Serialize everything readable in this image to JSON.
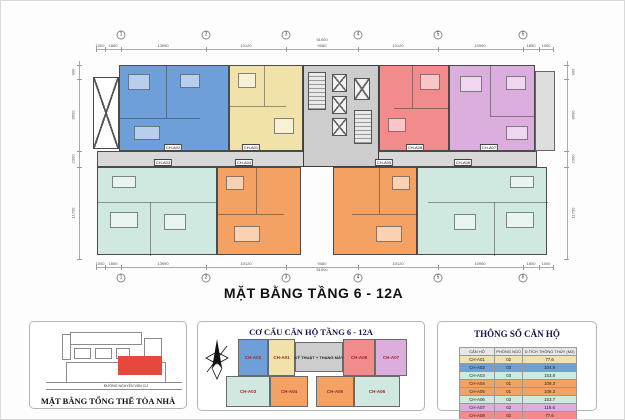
{
  "title": "MẶT BẰNG TẦNG 6 - 12A",
  "grid": {
    "bubbles": [
      "1",
      "2",
      "3",
      "4",
      "5",
      "6"
    ],
    "h_dims": [
      "1000",
      "1850",
      "13990",
      "10120",
      "9080",
      "10120",
      "10990",
      "1850",
      "1000"
    ],
    "h_total": "51000",
    "v_dims": [
      "900",
      "8600",
      "2300",
      "11700"
    ]
  },
  "apartments": [
    {
      "id": "CH-A01",
      "color": "#f1e2a9"
    },
    {
      "id": "CH-A02",
      "color": "#6f9fd8"
    },
    {
      "id": "CH-A03",
      "color": "#cfe9e1"
    },
    {
      "id": "CH-A04",
      "color": "#f4a263"
    },
    {
      "id": "CH-A05",
      "color": "#f4a263"
    },
    {
      "id": "CH-A06",
      "color": "#cfe9e1"
    },
    {
      "id": "CH-A07",
      "color": "#dcaede"
    },
    {
      "id": "CH-A08",
      "color": "#f28b8b"
    }
  ],
  "core": {
    "color": "#cdcdcd",
    "corridor_color": "#d8d8d8"
  },
  "site_panel": {
    "caption": "MẶT BẰNG TỔNG THỂ TÒA NHÀ",
    "street": "ĐƯỜNG NGUYỄN VĂN CỪ",
    "highlight_color": "#e8483b"
  },
  "legend_panel": {
    "title": "CƠ CẤU CĂN HỘ TẦNG 6 - 12A",
    "core_label": "KỸ THUẬT + THANG MÁY"
  },
  "specs_panel": {
    "title": "THÔNG SỐ CĂN HỘ",
    "columns": [
      "CĂN HỘ",
      "PHÒNG NGỦ",
      "D.TÍCH THÔNG THỦY (M2)"
    ],
    "rows": [
      {
        "unit": "CH-A01",
        "bedrooms": "02",
        "area": "77.6",
        "color": "#f1e2a9"
      },
      {
        "unit": "CH-A02",
        "bedrooms": "03",
        "area": "104.9",
        "color": "#6f9fd8"
      },
      {
        "unit": "CH-A03",
        "bedrooms": "03",
        "area": "153.8",
        "color": "#cfe9e1"
      },
      {
        "unit": "CH-A04",
        "bedrooms": "01",
        "area": "109.3",
        "color": "#f4a263"
      },
      {
        "unit": "CH-A05",
        "bedrooms": "01",
        "area": "109.3",
        "color": "#f4a263"
      },
      {
        "unit": "CH-A06",
        "bedrooms": "03",
        "area": "153.7",
        "color": "#cfe9e1"
      },
      {
        "unit": "CH-A07",
        "bedrooms": "02",
        "area": "119.6",
        "color": "#dcaede"
      },
      {
        "unit": "CH-A08",
        "bedrooms": "02",
        "area": "77.6",
        "color": "#f28b8b"
      }
    ]
  }
}
